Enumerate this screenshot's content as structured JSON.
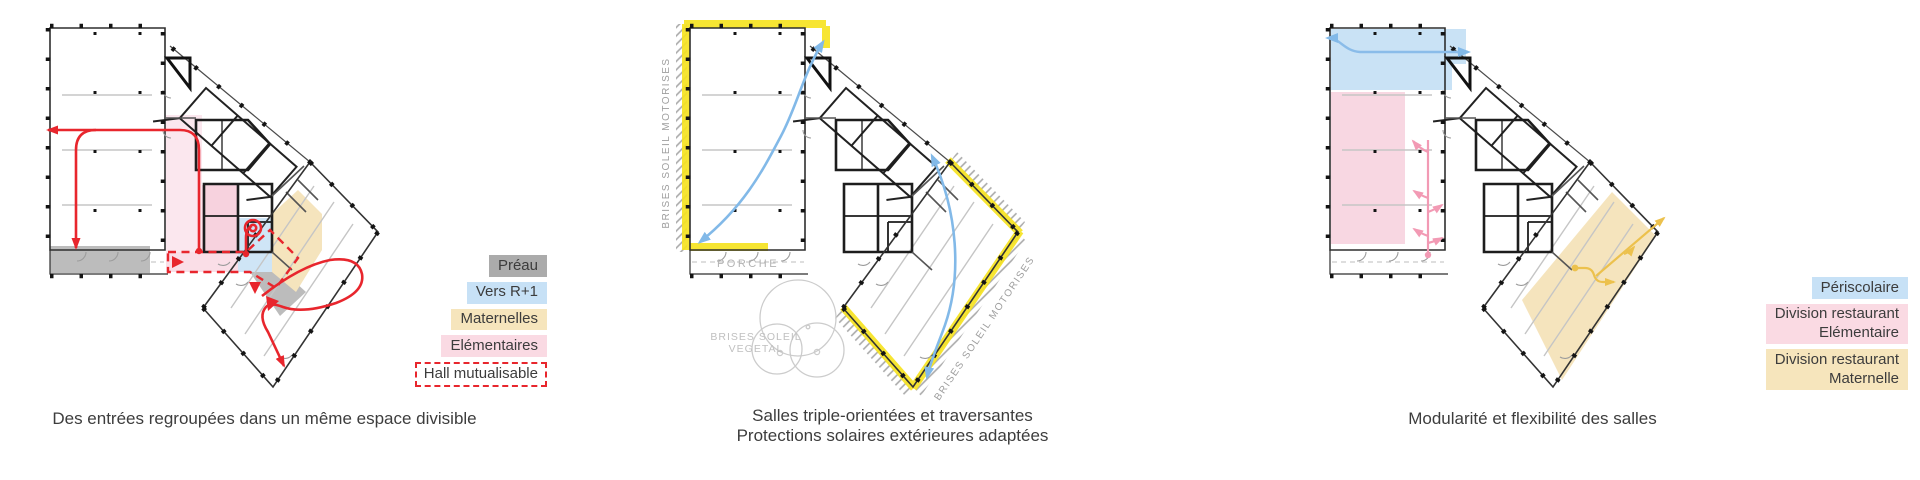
{
  "panels": [
    {
      "caption": "Des entrées regroupées dans un même espace divisible",
      "legend": [
        {
          "label": "Préau",
          "color": "#ababab"
        },
        {
          "label": "Vers R+1",
          "color": "#c7e1f6"
        },
        {
          "label": "Maternelles",
          "color": "#f6e5bc"
        },
        {
          "label": "Elémentaires",
          "color": "#fadae3"
        },
        {
          "label": "Hall mutualisable",
          "color": "#e8262d",
          "style": "dashed-outline"
        }
      ]
    },
    {
      "caption_line1": "Salles triple-orientées et traversantes",
      "caption_line2": "Protections solaires extérieures adaptées",
      "labels": {
        "brises_left": "BRISES SOLEIL MOTORISES",
        "brises_right": "BRISES SOLEIL MOTORISES",
        "porche": "PORCHE",
        "vegetal_line1": "BRISES SOLEIL",
        "vegetal_line2": "VEGETAL"
      }
    },
    {
      "caption": "Modularité et flexibilité des salles",
      "legend": [
        {
          "label": "Périscolaire",
          "color": "#c9e2f5"
        },
        {
          "label": "Division restaurant",
          "label2": "Elémentaire",
          "color": "#f8d7e2"
        },
        {
          "label": "Division restaurant",
          "label2": "Maternelle",
          "color": "#f5e4bd"
        }
      ]
    }
  ],
  "colors": {
    "accent_red": "#e8262d",
    "accent_yellow": "#f6e321",
    "arrow_blue": "#82b9e8",
    "arrow_pink": "#f29ab4",
    "arrow_yellow": "#ecc14d",
    "zone_gray": "#bcbcbc",
    "zone_blue": "#cfe5f6",
    "zone_pink_light": "#fbe7ee",
    "zone_pink": "#f7d2de",
    "zone_beige": "#f5e4bd",
    "plan_line": "#2e2e2e",
    "annotation_gray": "#9e9e9e"
  }
}
